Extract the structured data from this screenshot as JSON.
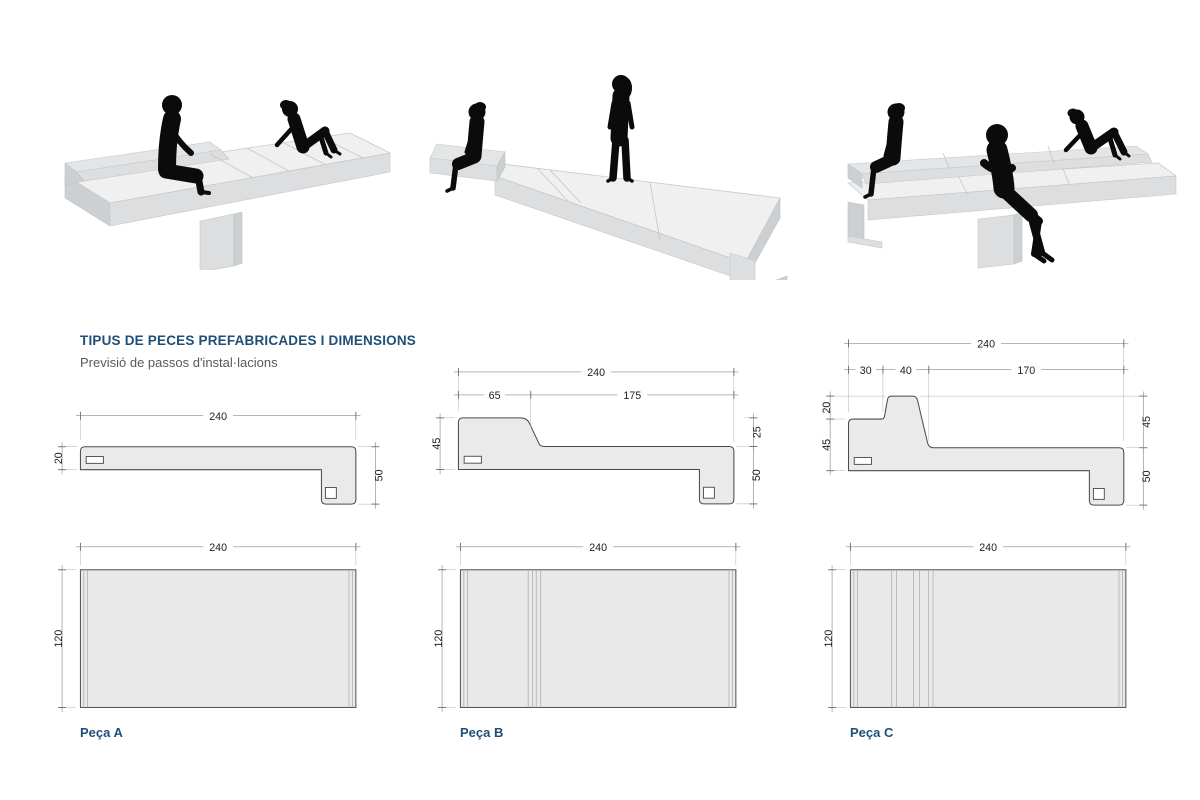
{
  "document": {
    "title": "TIPUS DE PECES PREFABRICADES I DIMENSIONS",
    "subtitle": "Previsió de passos d'instal·lacions"
  },
  "colors": {
    "heading": "#1F4E79",
    "subtitle_text": "#595959",
    "drawing_fill": "#EAEAEA",
    "drawing_stroke": "#4A4A4A",
    "dimension_line": "#8A8A8A",
    "silhouette": "#0B0B0B"
  },
  "pieces": [
    {
      "id": "A",
      "label": "Peça A",
      "section": {
        "total_width": "240",
        "seat_thickness": "20",
        "end_height": "50"
      },
      "plan": {
        "width": "240",
        "depth": "120"
      }
    },
    {
      "id": "B",
      "label": "Peça B",
      "section": {
        "total_width": "240",
        "back_width": "65",
        "seat_width": "175",
        "back_height": "45",
        "seat_drop": "25",
        "end_height": "50"
      },
      "plan": {
        "width": "240",
        "depth": "120"
      }
    },
    {
      "id": "C",
      "label": "Peça C",
      "section": {
        "total_width": "240",
        "seg1": "30",
        "seg2": "40",
        "seg3": "170",
        "crest_rise": "20",
        "back_height": "45",
        "right_drop": "45",
        "end_height": "50"
      },
      "plan": {
        "width": "240",
        "depth": "120"
      }
    }
  ]
}
